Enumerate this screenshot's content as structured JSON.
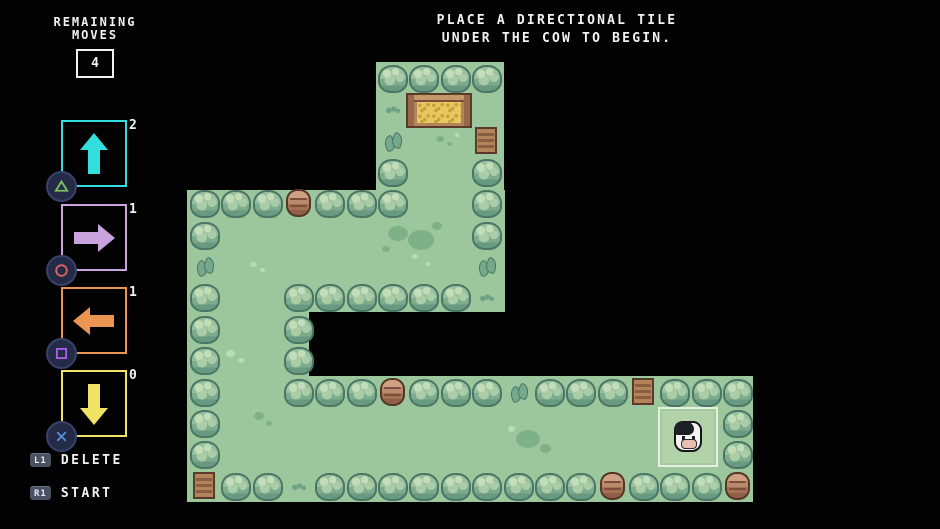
{
  "hud": {
    "moves_label_line1": "REMAINING",
    "moves_label_line2": "MOVES",
    "moves_value": "4",
    "instruction_line1": "PLACE A DIRECTIONAL TILE",
    "instruction_line2": "UNDER THE COW TO BEGIN.",
    "delete_key": "L1",
    "delete_label": "DELETE",
    "start_key": "R1",
    "start_label": "START"
  },
  "tile_palette": [
    {
      "direction": "up",
      "count": "2",
      "color": "#35dede",
      "ps_button": "triangle",
      "ps_color": "#7fbf5f"
    },
    {
      "direction": "right",
      "count": "1",
      "color": "#c9a3dd",
      "ps_button": "circle",
      "ps_color": "#e0615f"
    },
    {
      "direction": "left",
      "count": "1",
      "color": "#ec9551",
      "ps_button": "square",
      "ps_color": "#a95ee8"
    },
    {
      "direction": "down",
      "count": "0",
      "color": "#f0e464",
      "ps_button": "cross",
      "ps_color": "#5a8fd8"
    }
  ],
  "colors": {
    "background": "#020202",
    "text": "#f2f2f2",
    "grass": "#9cc79c",
    "grass_dark_patch": "#7fb189",
    "grass_light_patch": "#b9ddb2",
    "bush_outline": "#4b7564",
    "wood": "#b3835a",
    "hay": "#e8c75f",
    "highlight_border": "#e6f0de"
  },
  "map": {
    "tile_size": 31.35,
    "origin": {
      "x": 190,
      "y": 63
    },
    "grass_zones": [
      {
        "x": 376,
        "y": 62,
        "w": 128,
        "h": 156
      },
      {
        "x": 187,
        "y": 190,
        "w": 318,
        "h": 122
      },
      {
        "x": 187,
        "y": 190,
        "w": 122,
        "h": 312
      },
      {
        "x": 187,
        "y": 376,
        "w": 566,
        "h": 126
      }
    ],
    "bushes": [
      [
        6,
        0
      ],
      [
        7,
        0
      ],
      [
        8,
        0
      ],
      [
        9,
        0
      ],
      [
        6,
        3
      ],
      [
        6,
        4
      ],
      [
        9,
        3
      ],
      [
        9,
        4
      ],
      [
        9,
        5
      ],
      [
        0,
        4
      ],
      [
        1,
        4
      ],
      [
        2,
        4
      ],
      [
        4,
        4
      ],
      [
        5,
        4
      ],
      [
        0,
        5
      ],
      [
        0,
        7
      ],
      [
        0,
        8
      ],
      [
        0,
        9
      ],
      [
        0,
        10
      ],
      [
        0,
        11
      ],
      [
        0,
        12
      ],
      [
        3,
        7
      ],
      [
        4,
        7
      ],
      [
        5,
        7
      ],
      [
        6,
        7
      ],
      [
        7,
        7
      ],
      [
        8,
        7
      ],
      [
        3,
        8
      ],
      [
        3,
        9
      ],
      [
        3,
        10
      ],
      [
        4,
        10
      ],
      [
        5,
        10
      ],
      [
        7,
        10
      ],
      [
        8,
        10
      ],
      [
        9,
        10
      ],
      [
        11,
        10
      ],
      [
        12,
        10
      ],
      [
        13,
        10
      ],
      [
        15,
        10
      ],
      [
        16,
        10
      ],
      [
        17,
        10
      ],
      [
        17,
        11
      ],
      [
        17,
        12
      ],
      [
        1,
        13
      ],
      [
        2,
        13
      ],
      [
        4,
        13
      ],
      [
        5,
        13
      ],
      [
        6,
        13
      ],
      [
        7,
        13
      ],
      [
        8,
        13
      ],
      [
        9,
        13
      ],
      [
        10,
        13
      ],
      [
        11,
        13
      ],
      [
        12,
        13
      ],
      [
        14,
        13
      ],
      [
        15,
        13
      ],
      [
        16,
        13
      ]
    ],
    "ferns": [
      [
        0,
        6
      ],
      [
        9,
        6
      ],
      [
        6,
        2
      ],
      [
        10,
        10
      ]
    ],
    "tufts": [
      [
        6,
        1
      ],
      [
        9,
        7
      ],
      [
        3,
        13
      ]
    ],
    "barrels": [
      [
        3,
        4
      ],
      [
        6,
        10
      ],
      [
        13,
        13
      ],
      [
        17,
        13
      ]
    ],
    "crates": [
      [
        9,
        2
      ],
      [
        14,
        10
      ],
      [
        0,
        13
      ]
    ],
    "feeder": {
      "col": 7,
      "row": 1
    },
    "decorations": [
      {
        "x": 388,
        "y": 226,
        "w": 20,
        "h": 15,
        "kind": "dark"
      },
      {
        "x": 408,
        "y": 230,
        "w": 26,
        "h": 20,
        "kind": "dark"
      },
      {
        "x": 432,
        "y": 222,
        "w": 10,
        "h": 8,
        "kind": "dark"
      },
      {
        "x": 382,
        "y": 246,
        "w": 8,
        "h": 6,
        "kind": "dark"
      },
      {
        "x": 436,
        "y": 136,
        "w": 8,
        "h": 6,
        "kind": "dark"
      },
      {
        "x": 447,
        "y": 142,
        "w": 5,
        "h": 4,
        "kind": "dark"
      },
      {
        "x": 455,
        "y": 133,
        "w": 4,
        "h": 4,
        "kind": "light"
      },
      {
        "x": 250,
        "y": 262,
        "w": 7,
        "h": 5,
        "kind": "light"
      },
      {
        "x": 260,
        "y": 268,
        "w": 5,
        "h": 4,
        "kind": "light"
      },
      {
        "x": 412,
        "y": 254,
        "w": 6,
        "h": 5,
        "kind": "light"
      },
      {
        "x": 426,
        "y": 262,
        "w": 4,
        "h": 4,
        "kind": "light"
      },
      {
        "x": 226,
        "y": 350,
        "w": 9,
        "h": 7,
        "kind": "light"
      },
      {
        "x": 238,
        "y": 358,
        "w": 6,
        "h": 5,
        "kind": "light"
      },
      {
        "x": 254,
        "y": 412,
        "w": 10,
        "h": 8,
        "kind": "dark"
      },
      {
        "x": 266,
        "y": 421,
        "w": 6,
        "h": 5,
        "kind": "dark"
      },
      {
        "x": 516,
        "y": 430,
        "w": 24,
        "h": 18,
        "kind": "dark"
      },
      {
        "x": 540,
        "y": 444,
        "w": 11,
        "h": 9,
        "kind": "dark"
      },
      {
        "x": 508,
        "y": 426,
        "w": 7,
        "h": 6,
        "kind": "light"
      },
      {
        "x": 695,
        "y": 416,
        "w": 8,
        "h": 6,
        "kind": "light"
      },
      {
        "x": 706,
        "y": 425,
        "w": 5,
        "h": 4,
        "kind": "light"
      }
    ],
    "highlight": {
      "x": 658,
      "y": 407,
      "size": 60
    },
    "cow": {
      "x": 674,
      "y": 421
    }
  }
}
